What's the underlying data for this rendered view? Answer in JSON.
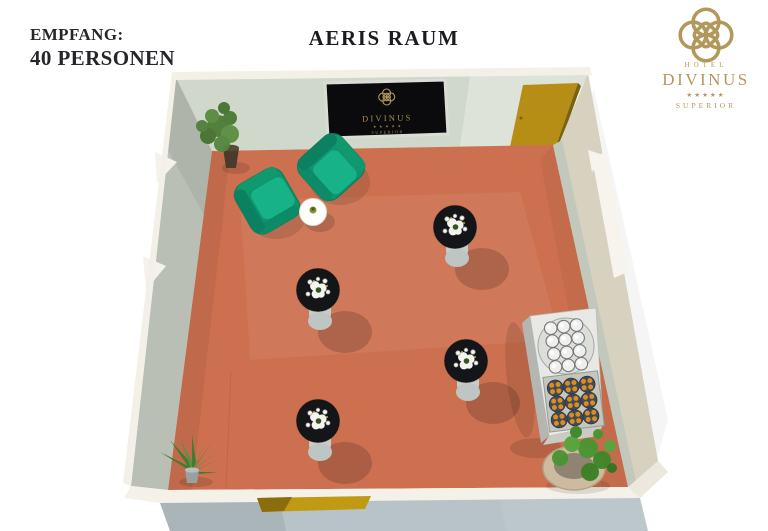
{
  "header": {
    "capacity_line1": "EMPFANG:",
    "capacity_line2": "40 PERSONEN",
    "title": "AERIS RAUM"
  },
  "brand": {
    "hotel": "HOTEL",
    "name": "DIVINUS",
    "stars": "★★★★★",
    "tier": "SUPERIOR"
  },
  "wall_sign": {
    "name": "DIVINUS",
    "stars": "★ ★ ★ ★ ★",
    "tier": "SUPERIOR"
  },
  "scene": {
    "colors": {
      "floor": "#cc7050",
      "armchair_green": "#0f9671",
      "interior_wall": "#bcc2b7",
      "back_wall": "#d0d7cb",
      "exterior_right_wall": "#d7d1bf",
      "front_exterior": "#b7c3c8",
      "door_yellow": "#b68e16",
      "logo_gold": "#b3985c",
      "cocktail_table_top": "#17181a"
    },
    "furniture_counts": {
      "cocktail_tables": 4,
      "armchairs": 2,
      "side_tables": 1,
      "buffet_tables": 1,
      "plants": 3
    }
  }
}
